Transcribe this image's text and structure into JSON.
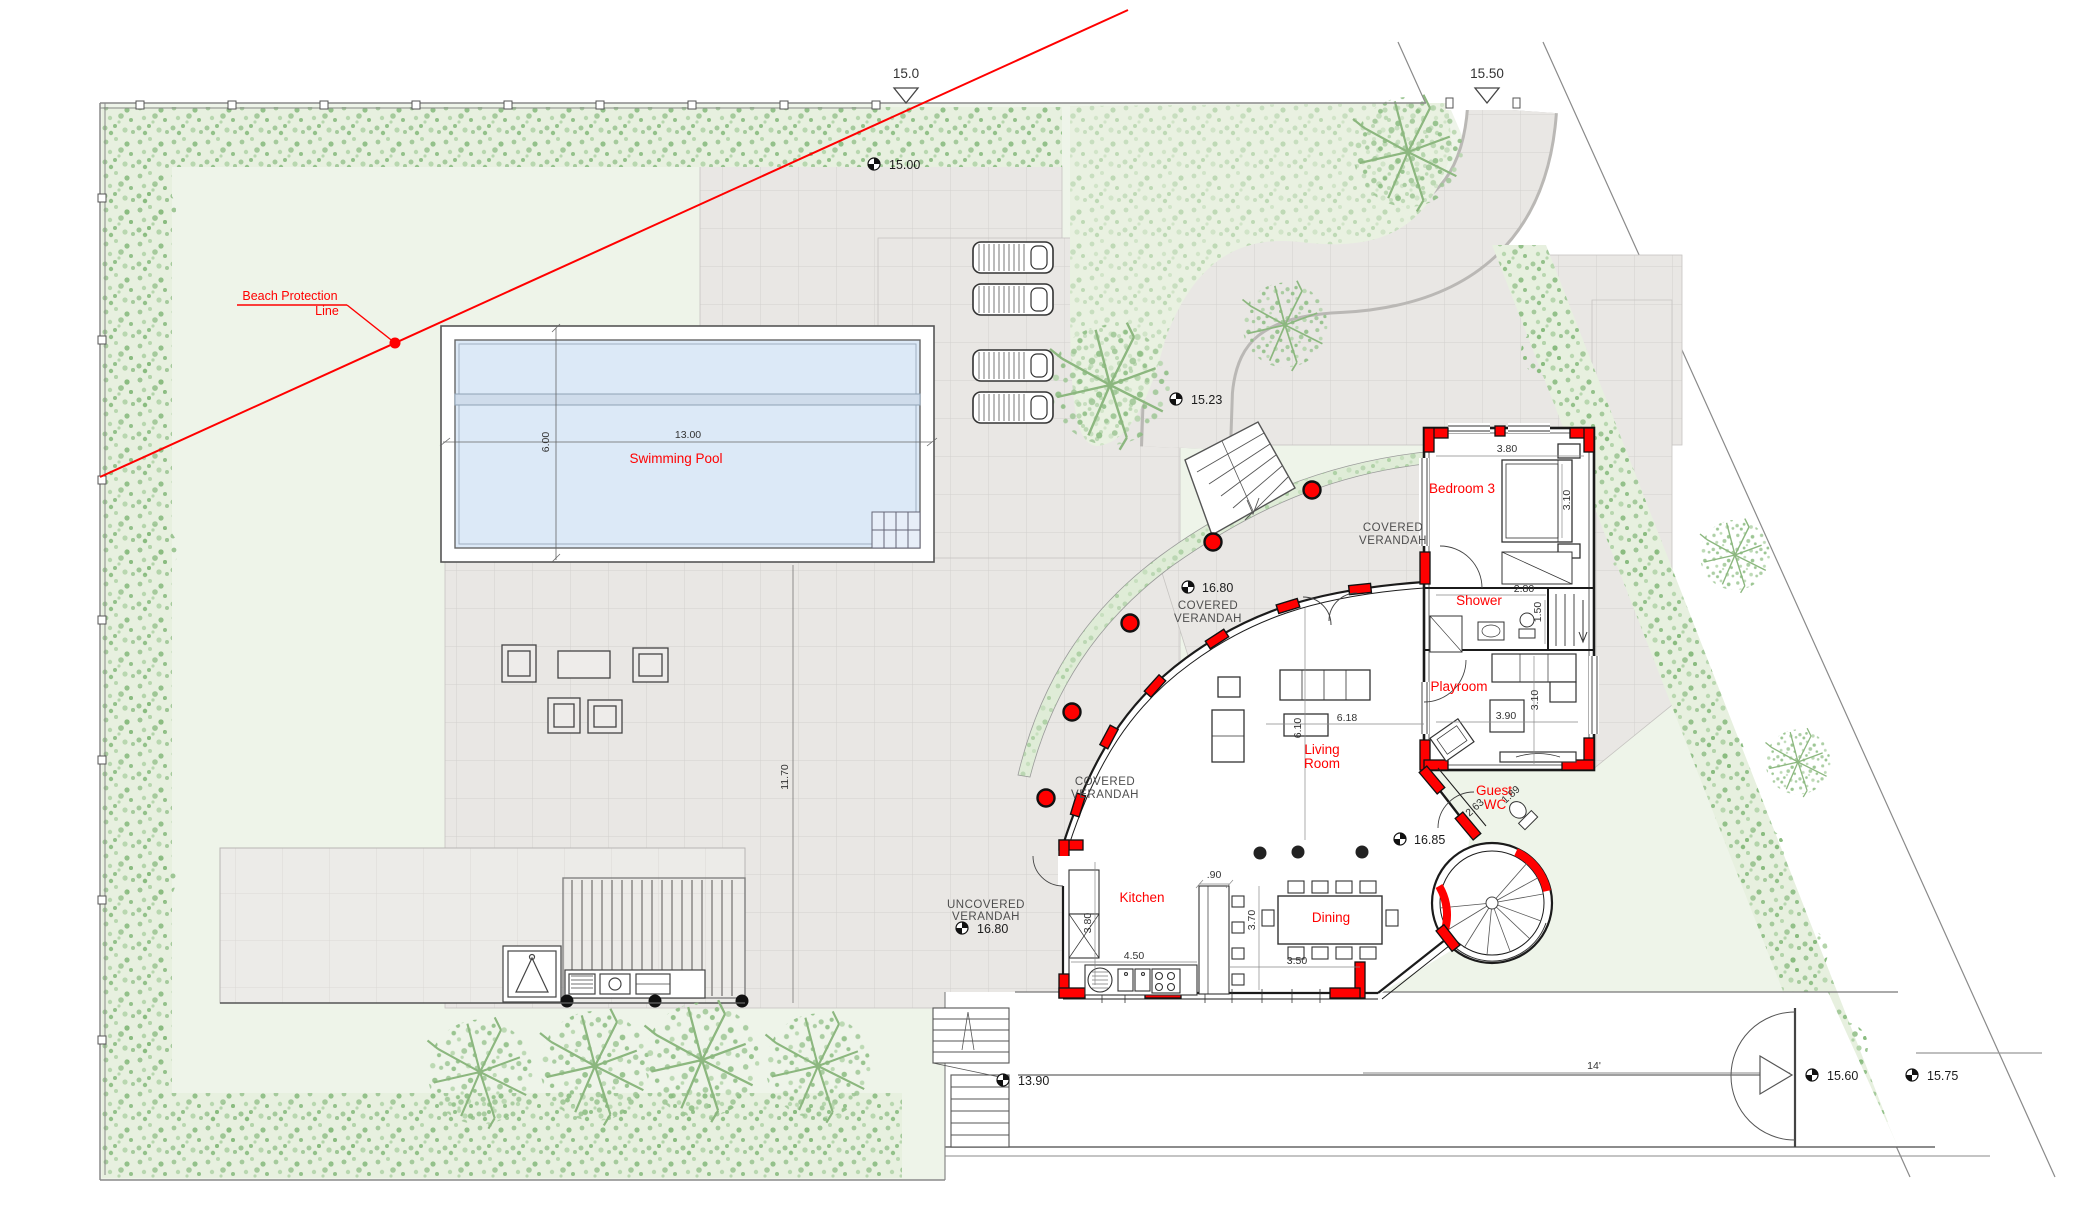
{
  "beach": {
    "l1": "Beach Protection",
    "l2": "Line"
  },
  "datum": {
    "top": "15.0",
    "gate": "15.50"
  },
  "spots": {
    "lawn": "15.00",
    "drive": "15.23",
    "verandah": "16.80",
    "uncovered": "16.80",
    "court": "16.85",
    "beach_stair": "13.90",
    "entry": "15.60",
    "road": "15.75"
  },
  "slope": "14'",
  "pool": {
    "label": "Swimming Pool",
    "len": "13.00",
    "wid": "6.00"
  },
  "patio_dim": "11.70",
  "rooms": {
    "bedroom3": {
      "label": "Bedroom 3",
      "w": "3.80",
      "d": "3.10"
    },
    "shower": {
      "label": "Shower",
      "w": "2.80",
      "d": "1.50"
    },
    "playroom": {
      "label": "Playroom",
      "w": "3.90",
      "d": "3.10"
    },
    "guest_wc": {
      "l1": "Guest",
      "l2": "WC",
      "w": "2.63",
      "d": "1.89"
    },
    "living": {
      "l1": "Living",
      "l2": "Room",
      "w": "6.18",
      "d": "6.10"
    },
    "kitchen": {
      "label": "Kitchen",
      "d": "3.80",
      "w": "4.50",
      "island": ".90"
    },
    "dining": {
      "label": "Dining",
      "d": "3.70",
      "w": "3.50"
    }
  },
  "areas": {
    "covered1": "COVERED",
    "covered2": "VERANDAH",
    "uncovered1": "UNCOVERED",
    "uncovered2": "VERANDAH"
  },
  "colors": {
    "accent_red": "#ff0000",
    "lawn": "#eef4e9",
    "water": "#dce9f7",
    "paving": "#e9e7e4"
  }
}
